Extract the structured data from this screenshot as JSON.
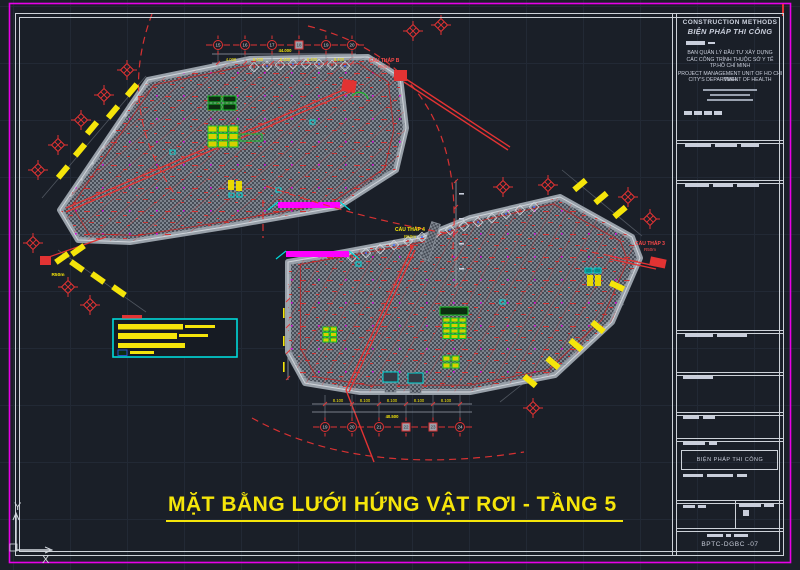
{
  "app": {
    "background": "#1a1f28",
    "frame_color": "#cdd2d9",
    "paper_edge_color": "#e800e8",
    "grid_color": "#222935"
  },
  "drawing_title": {
    "text": "MẶT BẰNG  LƯỚI HỨNG VẬT RƠI  - TẦNG 5",
    "color": "#f5e50a"
  },
  "ucs": {
    "x_label": "X",
    "y_label": "Y"
  },
  "title_block": {
    "company_en": "CONSTRUCTION METHODS",
    "company_vi": "BIỆN PHÁP THI CÔNG",
    "owner_lines": [
      "BAN QUẢN LÝ ĐẦU TƯ XÂY DỰNG",
      "CÁC CÔNG TRÌNH THUỘC SỞ Y TẾ",
      "TP.HỒ CHÍ MINH",
      "PROJECT MANAGEMENT UNIT OF HO CHI MINH",
      "CITY'S DEPARTMENT OF HEALTH"
    ],
    "stage_label": "BIỆN PHÁP THI CÔNG",
    "drawing_no": "BPTC-DGBC -07"
  },
  "plan": {
    "cranes": [
      {
        "label": "CẨU THÁP B",
        "radius": "R50m"
      },
      {
        "label": "CẨU THÁP 4",
        "radius": "R50m"
      },
      {
        "label": "CẨU THÁP 3",
        "radius": "R50m"
      },
      {
        "label": "",
        "radius": "R50m"
      }
    ],
    "grid_bubbles_top": [
      "15",
      "16",
      "17",
      "18",
      "19",
      "20"
    ],
    "grid_bubbles_bottom": [
      "19",
      "20",
      "21",
      "22",
      "23",
      "24"
    ],
    "dims_top": {
      "segments": [
        "4.000",
        "8.400",
        "8.400",
        "8.400",
        "8.400"
      ],
      "total": "44.000"
    },
    "dims_bottom": {
      "segments": [
        "8.100",
        "8.100",
        "8.100",
        "8.100",
        "8.100"
      ],
      "total": "40.500"
    },
    "colors": {
      "slab_hatch": "#7e858f",
      "structure_red": "#e23333",
      "safety_yellow": "#f5e50a",
      "net_magenta": "#ff00ff",
      "equipment_green": "#18c428",
      "marker_cyan": "#00d9d9"
    }
  }
}
